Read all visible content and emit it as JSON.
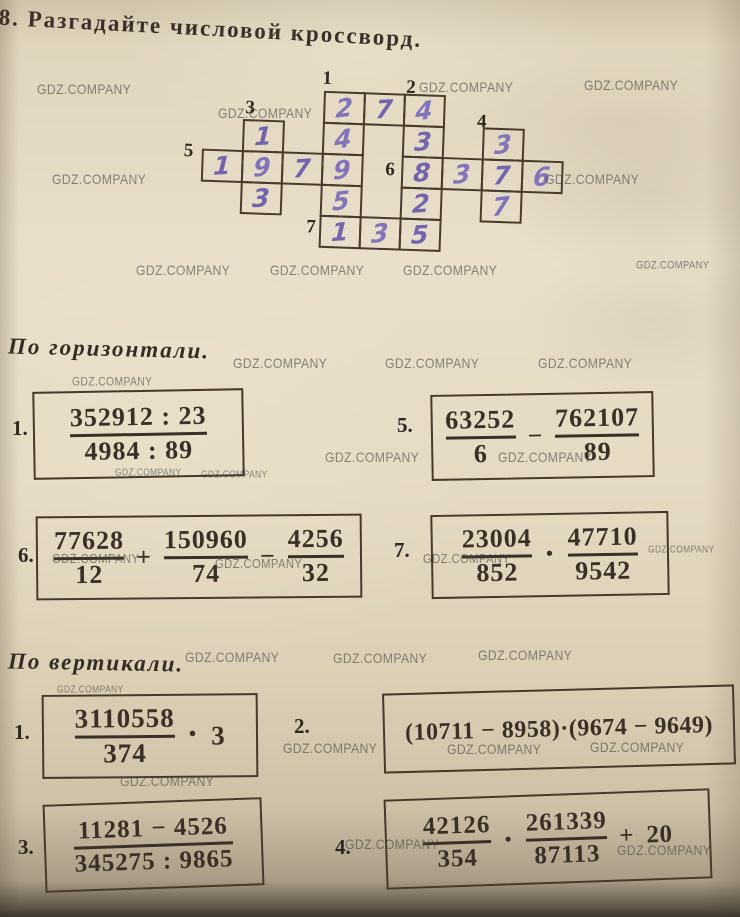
{
  "page": {
    "title_number": "38.",
    "title": "Разгадайте числовой кроссворд."
  },
  "watermark": {
    "text": "GDZ.COMPANY"
  },
  "colors": {
    "paper": "#e5dac3",
    "printed_ink": "#3a3025",
    "handwriting_ink": "#7464ae",
    "grid_line": "#4a3c2c",
    "watermark": "#494641"
  },
  "crossword": {
    "clue_labels": [
      "1",
      "2",
      "3",
      "4",
      "5",
      "6",
      "7"
    ],
    "cells": [
      {
        "col": 3,
        "row": 0,
        "digit": "2"
      },
      {
        "col": 4,
        "row": 0,
        "digit": "7"
      },
      {
        "col": 5,
        "row": 0,
        "digit": "4"
      },
      {
        "col": 1,
        "row": 1,
        "digit": "1"
      },
      {
        "col": 3,
        "row": 1,
        "digit": "4"
      },
      {
        "col": 5,
        "row": 1,
        "digit": "3"
      },
      {
        "col": 7,
        "row": 1,
        "digit": "3"
      },
      {
        "col": 0,
        "row": 2,
        "digit": "1"
      },
      {
        "col": 1,
        "row": 2,
        "digit": "9"
      },
      {
        "col": 2,
        "row": 2,
        "digit": "7"
      },
      {
        "col": 3,
        "row": 2,
        "digit": "9"
      },
      {
        "col": 5,
        "row": 2,
        "digit": "8"
      },
      {
        "col": 6,
        "row": 2,
        "digit": "3"
      },
      {
        "col": 7,
        "row": 2,
        "digit": "7"
      },
      {
        "col": 8,
        "row": 2,
        "digit": "6"
      },
      {
        "col": 1,
        "row": 3,
        "digit": "3"
      },
      {
        "col": 3,
        "row": 3,
        "digit": "5"
      },
      {
        "col": 5,
        "row": 3,
        "digit": "2"
      },
      {
        "col": 7,
        "row": 3,
        "digit": "7"
      },
      {
        "col": 3,
        "row": 4,
        "digit": "1"
      },
      {
        "col": 4,
        "row": 4,
        "digit": "3"
      },
      {
        "col": 5,
        "row": 4,
        "digit": "5"
      }
    ],
    "answers_across": {
      "1": "274",
      "5": "1979",
      "6": "8376",
      "7": "135"
    },
    "answers_down": {
      "1": "24951",
      "2": "43825",
      "3": "193",
      "4": "377"
    }
  },
  "across": {
    "heading": "По горизонтали.",
    "problems": [
      {
        "id": "a1",
        "label": "1.",
        "parts": [
          {
            "num": "352912 : 23",
            "den": "4984 : 89"
          }
        ]
      },
      {
        "id": "a5",
        "label": "5.",
        "parts": [
          {
            "num": "63252",
            "den": "6"
          },
          "−",
          {
            "num": "762107",
            "den": "89"
          }
        ]
      },
      {
        "id": "a6",
        "label": "6.",
        "parts": [
          {
            "num": "77628",
            "den": "12"
          },
          "+",
          {
            "num": "150960",
            "den": "74"
          },
          "−",
          {
            "num": "4256",
            "den": "32"
          }
        ]
      },
      {
        "id": "a7",
        "label": "7.",
        "parts": [
          {
            "num": "23004",
            "den": "852"
          },
          "·",
          {
            "num": "47710",
            "den": "9542"
          }
        ]
      }
    ]
  },
  "down": {
    "heading": "По вертикали.",
    "problems": [
      {
        "id": "d1",
        "label": "1.",
        "parts": [
          {
            "num": "3110558",
            "den": "374"
          },
          "·",
          "3"
        ]
      },
      {
        "id": "d2",
        "label": "2.",
        "parts": [
          "(10711 − 8958)·(9674 − 9649)"
        ]
      },
      {
        "id": "d3",
        "label": "3.",
        "parts": [
          {
            "num": "11281 − 4526",
            "den": "345275 : 9865"
          }
        ]
      },
      {
        "id": "d4",
        "label": "4.",
        "parts": [
          {
            "num": "42126",
            "den": "354"
          },
          "·",
          {
            "num": "261339",
            "den": "87113"
          },
          "+",
          "20"
        ]
      }
    ]
  }
}
